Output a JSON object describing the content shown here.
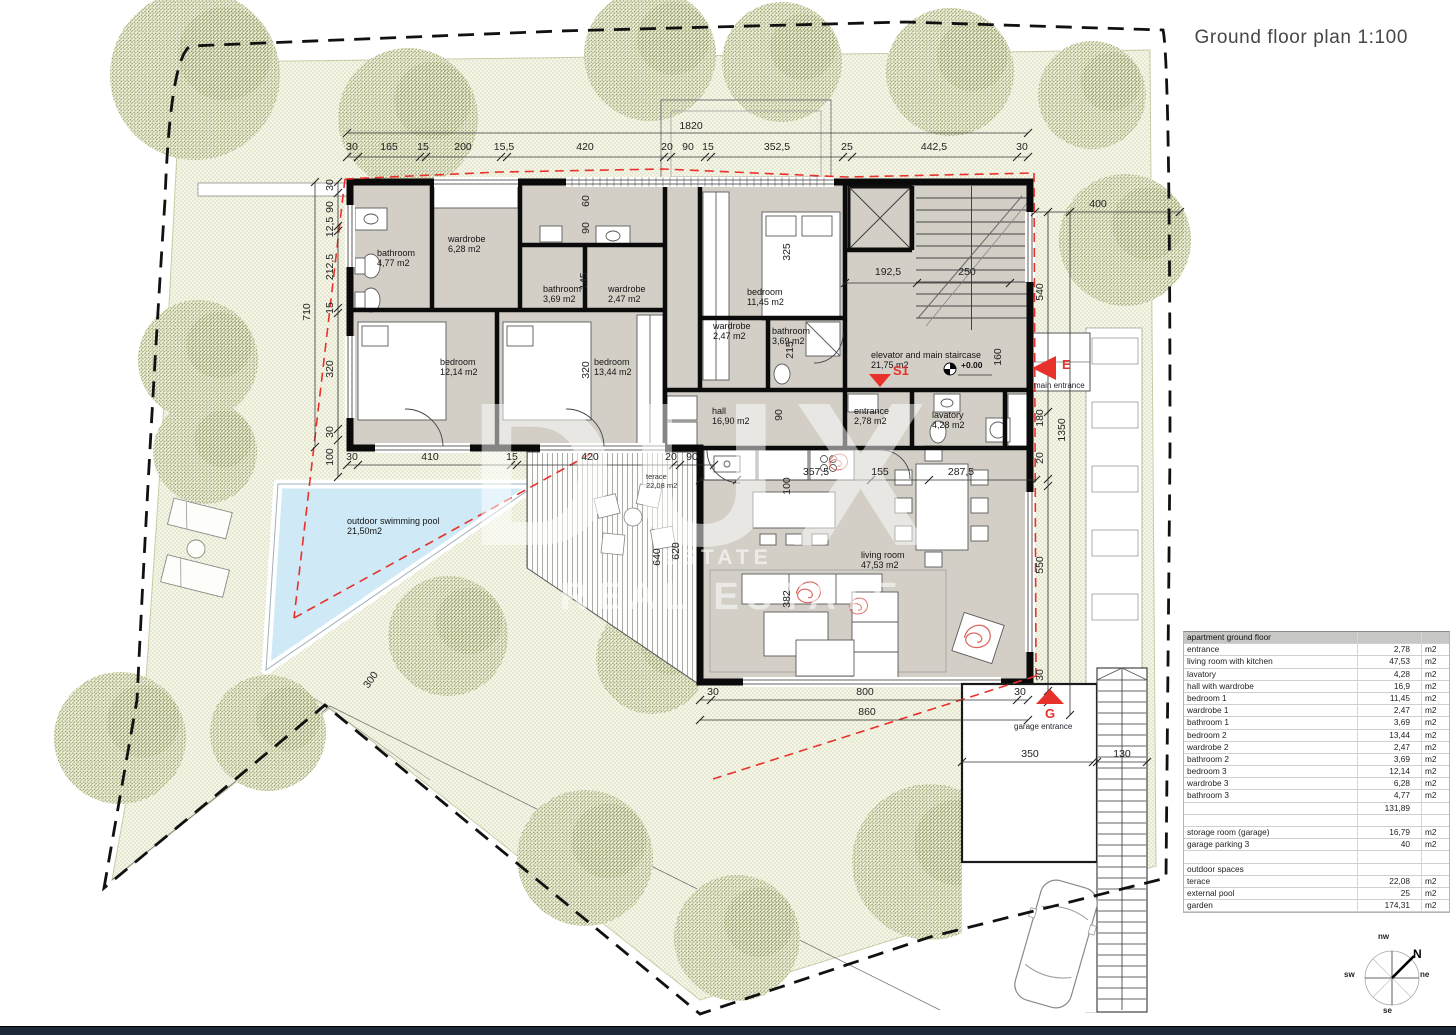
{
  "title": "Ground floor plan  1:100",
  "legend": {
    "building_line_label": "building line",
    "building_line_color": "#e8312a"
  },
  "watermark": {
    "big": "DUX",
    "mid": "ESTATE",
    "sub": "REAL ESTATE"
  },
  "compass": {
    "n": "N",
    "nw": "nw",
    "ne": "ne",
    "sw": "sw",
    "se": "se"
  },
  "markers": {
    "main_entrance": {
      "code": "E",
      "label": "main entrance"
    },
    "garage_entrance": {
      "code": "G",
      "label": "garage entrance"
    },
    "staircase_code": "S1",
    "level": "+0.00"
  },
  "rooms": [
    {
      "name": "bathroom",
      "area": "4,77 m2",
      "x": 377,
      "y": 248
    },
    {
      "name": "wardrobe",
      "area": "6,28 m2",
      "x": 448,
      "y": 234
    },
    {
      "name": "bathroom",
      "area": "3,69 m2",
      "x": 543,
      "y": 284
    },
    {
      "name": "wardrobe",
      "area": "2,47 m2",
      "x": 608,
      "y": 284
    },
    {
      "name": "bedroom",
      "area": "12,14 m2",
      "x": 440,
      "y": 357
    },
    {
      "name": "bedroom",
      "area": "13,44 m2",
      "x": 594,
      "y": 357
    },
    {
      "name": "bedroom",
      "area": "11,45 m2",
      "x": 747,
      "y": 287
    },
    {
      "name": "wardrobe",
      "area": "2,47 m2",
      "x": 713,
      "y": 321
    },
    {
      "name": "bathroom",
      "area": "3,69 m2",
      "x": 772,
      "y": 326
    },
    {
      "name": "elevator and main staircase",
      "area": "21,75 m2",
      "x": 871,
      "y": 350
    },
    {
      "name": "hall",
      "area": "16,90 m2",
      "x": 712,
      "y": 406
    },
    {
      "name": "entrance",
      "area": "2,78 m2",
      "x": 854,
      "y": 406
    },
    {
      "name": "lavatory",
      "area": "4,28 m2",
      "x": 932,
      "y": 410
    },
    {
      "name": "living room",
      "area": "47,53 m2",
      "x": 861,
      "y": 550
    },
    {
      "name": "terace",
      "area": "22,08 m2",
      "x": 646,
      "y": 473,
      "small": true
    },
    {
      "name": "outdoor swimming pool",
      "area": "21,50m2",
      "x": 347,
      "y": 516
    }
  ],
  "dimensions": [
    {
      "t": "30",
      "x": 352,
      "y": 147
    },
    {
      "t": "165",
      "x": 389,
      "y": 147
    },
    {
      "t": "15",
      "x": 423,
      "y": 147
    },
    {
      "t": "200",
      "x": 463,
      "y": 147
    },
    {
      "t": "15,5",
      "x": 504,
      "y": 147
    },
    {
      "t": "420",
      "x": 585,
      "y": 147
    },
    {
      "t": "20",
      "x": 667,
      "y": 147
    },
    {
      "t": "90",
      "x": 688,
      "y": 147
    },
    {
      "t": "15",
      "x": 708,
      "y": 147
    },
    {
      "t": "352,5",
      "x": 777,
      "y": 147
    },
    {
      "t": "25",
      "x": 847,
      "y": 147
    },
    {
      "t": "442,5",
      "x": 934,
      "y": 147
    },
    {
      "t": "30",
      "x": 1022,
      "y": 147
    },
    {
      "t": "1820",
      "x": 691,
      "y": 126
    },
    {
      "t": "30",
      "x": 352,
      "y": 457
    },
    {
      "t": "410",
      "x": 430,
      "y": 457
    },
    {
      "t": "15",
      "x": 512,
      "y": 457
    },
    {
      "t": "420",
      "x": 590,
      "y": 457
    },
    {
      "t": "20",
      "x": 671,
      "y": 457
    },
    {
      "t": "90",
      "x": 692,
      "y": 457
    },
    {
      "t": "357,5",
      "x": 816,
      "y": 472
    },
    {
      "t": "155",
      "x": 880,
      "y": 472
    },
    {
      "t": "287,5",
      "x": 961,
      "y": 472
    },
    {
      "t": "30",
      "x": 713,
      "y": 692
    },
    {
      "t": "800",
      "x": 865,
      "y": 692
    },
    {
      "t": "30",
      "x": 1020,
      "y": 692
    },
    {
      "t": "860",
      "x": 867,
      "y": 712
    },
    {
      "t": "350",
      "x": 1030,
      "y": 754
    },
    {
      "t": "130",
      "x": 1122,
      "y": 754
    },
    {
      "t": "30",
      "x": 330,
      "y": 185,
      "r": -90
    },
    {
      "t": "90",
      "x": 330,
      "y": 207,
      "r": -90
    },
    {
      "t": "12,5",
      "x": 330,
      "y": 227,
      "r": -90
    },
    {
      "t": "212,5",
      "x": 330,
      "y": 267,
      "r": -90
    },
    {
      "t": "15",
      "x": 330,
      "y": 308,
      "r": -90
    },
    {
      "t": "320",
      "x": 330,
      "y": 369,
      "r": -90
    },
    {
      "t": "30",
      "x": 330,
      "y": 432,
      "r": -90
    },
    {
      "t": "100",
      "x": 330,
      "y": 457,
      "r": -90
    },
    {
      "t": "710",
      "x": 307,
      "y": 312,
      "r": -90
    },
    {
      "t": "540",
      "x": 1040,
      "y": 292,
      "r": -90
    },
    {
      "t": "180",
      "x": 1040,
      "y": 418,
      "r": -90
    },
    {
      "t": "20",
      "x": 1040,
      "y": 458,
      "r": -90
    },
    {
      "t": "550",
      "x": 1040,
      "y": 565,
      "r": -90
    },
    {
      "t": "30",
      "x": 1040,
      "y": 675,
      "r": -90
    },
    {
      "t": "1350",
      "x": 1062,
      "y": 430,
      "r": -90
    },
    {
      "t": "400",
      "x": 1098,
      "y": 204
    },
    {
      "t": "60",
      "x": 586,
      "y": 201,
      "r": -90
    },
    {
      "t": "90",
      "x": 586,
      "y": 228,
      "r": -90
    },
    {
      "t": "145",
      "x": 584,
      "y": 281,
      "r": -90
    },
    {
      "t": "320",
      "x": 586,
      "y": 370,
      "r": -90
    },
    {
      "t": "325",
      "x": 787,
      "y": 252,
      "r": -90
    },
    {
      "t": "215",
      "x": 790,
      "y": 350,
      "r": -90
    },
    {
      "t": "160",
      "x": 998,
      "y": 357,
      "r": -90
    },
    {
      "t": "90",
      "x": 779,
      "y": 415,
      "r": -90
    },
    {
      "t": "100",
      "x": 787,
      "y": 486,
      "r": -90
    },
    {
      "t": "382",
      "x": 787,
      "y": 599,
      "r": -90
    },
    {
      "t": "640",
      "x": 657,
      "y": 557,
      "r": -90
    },
    {
      "t": "620",
      "x": 676,
      "y": 551,
      "r": -90
    },
    {
      "t": "192,5",
      "x": 888,
      "y": 272
    },
    {
      "t": "250",
      "x": 967,
      "y": 272
    },
    {
      "t": "300",
      "x": 371,
      "y": 680,
      "r": -55
    }
  ],
  "area_table": {
    "rows": [
      {
        "l": "apartment ground floor",
        "v": "",
        "u": "",
        "type": "header"
      },
      {
        "l": "entrance",
        "v": "2,78",
        "u": "m2"
      },
      {
        "l": "living room with kitchen",
        "v": "47,53",
        "u": "m2"
      },
      {
        "l": "lavatory",
        "v": "4,28",
        "u": "m2"
      },
      {
        "l": "hall with wardrobe",
        "v": "16,9",
        "u": "m2"
      },
      {
        "l": "bedroom 1",
        "v": "11,45",
        "u": "m2"
      },
      {
        "l": "wardrobe 1",
        "v": "2,47",
        "u": "m2"
      },
      {
        "l": "bathroom 1",
        "v": "3,69",
        "u": "m2"
      },
      {
        "l": "bedroom 2",
        "v": "13,44",
        "u": "m2"
      },
      {
        "l": "wardrobe 2",
        "v": "2,47",
        "u": "m2"
      },
      {
        "l": "bathroom 2",
        "v": "3,69",
        "u": "m2"
      },
      {
        "l": "bedroom 3",
        "v": "12,14",
        "u": "m2"
      },
      {
        "l": "wardrobe 3",
        "v": "6,28",
        "u": "m2"
      },
      {
        "l": "bathroom 3",
        "v": "4,77",
        "u": "m2"
      },
      {
        "l": "",
        "v": "131,89",
        "u": "",
        "type": "total"
      },
      {
        "l": "",
        "v": "",
        "u": "",
        "type": "spacer"
      },
      {
        "l": "storage room (garage)",
        "v": "16,79",
        "u": "m2"
      },
      {
        "l": "garage parking 3",
        "v": "40",
        "u": "m2"
      },
      {
        "l": "",
        "v": "",
        "u": "",
        "type": "spacer"
      },
      {
        "l": "outdoor spaces",
        "v": "",
        "u": "",
        "type": "section"
      },
      {
        "l": "terace",
        "v": "22,08",
        "u": "m2"
      },
      {
        "l": "external pool",
        "v": "25",
        "u": "m2"
      },
      {
        "l": "garden",
        "v": "174,31",
        "u": "m2"
      }
    ]
  }
}
